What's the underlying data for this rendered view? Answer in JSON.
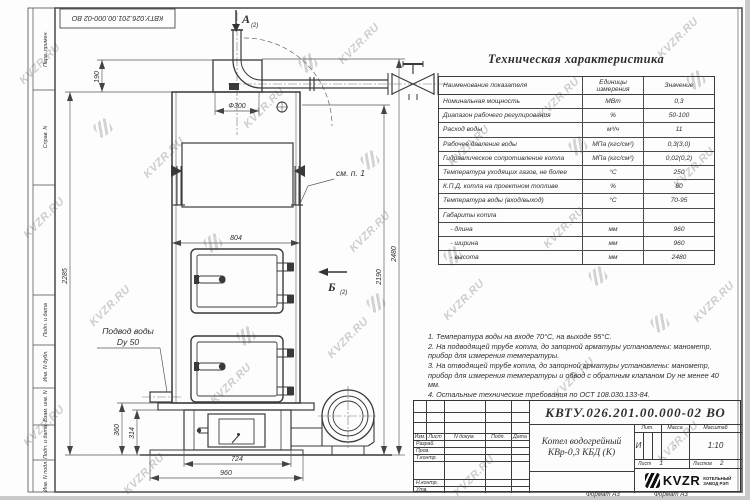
{
  "watermark": {
    "text": "KVZR.RU"
  },
  "frame": {
    "stamp_top_left": "КВТУ.026.201.00.000-02  ВО",
    "margin_labels": [
      "Перв. примен.",
      "Справ. N",
      "Подп. и дата",
      "Инв. N дубл.",
      "Взам. инв. N",
      "Подп. и дата",
      "Инв. N подл."
    ],
    "format_note_left": "Формат А3",
    "format_note_right": "Формат А3"
  },
  "spec_table": {
    "title": "Техническая характеристика",
    "columns": [
      "Наименование показателя",
      "Единицы измерения",
      "Значение"
    ],
    "rows": [
      [
        "Номинальная мощность",
        "МВт",
        "0,3"
      ],
      [
        "Диапазон рабочего регулирования",
        "%",
        "50-100"
      ],
      [
        "Расход воды",
        "м³/ч",
        "11"
      ],
      [
        "Рабочее давление воды",
        "МПа (кгс/см²)",
        "0,3(3,0)"
      ],
      [
        "Гидравлическое сопротивление котла",
        "МПа (кгс/см²)",
        "0,02(0,2)"
      ],
      [
        "Температура уходящих газов, не более",
        "°С",
        "250"
      ],
      [
        "К.П.Д. котла на проектном топливе",
        "%",
        "80"
      ],
      [
        "Температура воды (вход/выход)",
        "°С",
        "70-95"
      ],
      [
        "Габариты котла",
        "",
        ""
      ],
      [
        "    - длина",
        "мм",
        "960"
      ],
      [
        "    - ширина",
        "мм",
        "960"
      ],
      [
        "    - высота",
        "мм",
        "2480"
      ]
    ]
  },
  "notes": [
    "1.   Температура воды на входе 70°С, на выходе 95°С.",
    "2.   На подводящей трубе котла, до запорной арматуры установлены: манометр, прибор для измерения температуры.",
    "3.   На отводящей трубе котла, до запорной арматуры установлены: манометр, прибор для измерения температуры и обвод с обратным клапаном Dу не менее 40 мм.",
    "4.   Остальные технические требования по ОСТ 108.030.133-84."
  ],
  "dims": {
    "d190": "190",
    "d300": "Ф300",
    "d804": "804",
    "d2285": "2285",
    "d2190": "2190",
    "d2480": "2480",
    "d360": "360",
    "d314": "314",
    "d724": "724",
    "d960": "960"
  },
  "callouts": {
    "view_a": "А",
    "view_b": "Б",
    "sheet_ref": "(2)",
    "see_note": "см. п. 1",
    "water_line1": "Подвод воды",
    "water_line2": "Dу 50"
  },
  "title_block": {
    "designation": "КВТУ.026.201.00.000-02  ВО",
    "product_line1": "Котел водогрейный",
    "product_line2": "КВр-0,3  КБД  (К)",
    "lit_header": "Лит.",
    "mass_header": "Масса",
    "scale_header": "Масштаб",
    "lit": "И",
    "mass": "-",
    "scale": "1:10",
    "sheet_label": "Лист",
    "sheet": "1",
    "sheets_label": "Листов",
    "sheets": "2",
    "rev_headers": [
      "Изм.",
      "Лист",
      "N докум.",
      "Подп.",
      "Дата"
    ],
    "sig_labels": [
      "Разраб.",
      "Пров.",
      "Т.контр.",
      "Н.контр.",
      "Утв."
    ],
    "company_logo": "KVZR",
    "company_sub1": "КОТЕЛЬНЫЙ",
    "company_sub2": "ЗАВОД РЭП"
  }
}
